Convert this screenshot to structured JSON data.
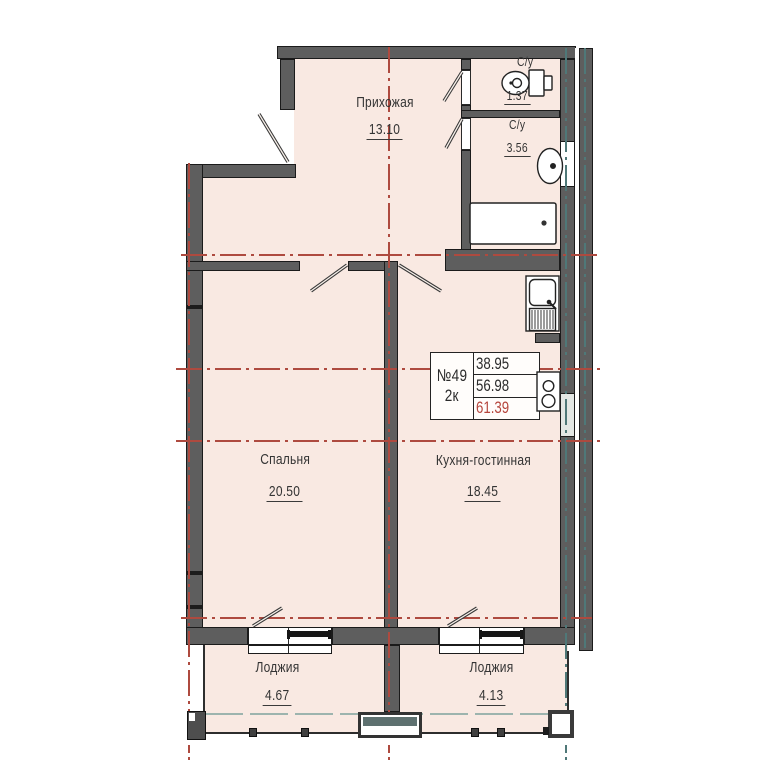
{
  "plan_type": "apartment floor plan",
  "stamp": {
    "apartment_number": "№49",
    "rooms_label": "2к",
    "living_area": "38.95",
    "area_without_loggias": "56.98",
    "total_area": "61.39"
  },
  "rooms": {
    "hallway": {
      "name": "Прихожая",
      "area": "13.10"
    },
    "wc_small": {
      "name": "С/у",
      "area": "1.37"
    },
    "wc_big": {
      "name": "С/у",
      "area": "3.56"
    },
    "bedroom": {
      "name": "Спальня",
      "area": "20.50"
    },
    "kitchen": {
      "name": "Кухня-гостинная",
      "area": "18.45"
    },
    "loggia_left": {
      "name": "Лоджия",
      "area": "4.67"
    },
    "loggia_right": {
      "name": "Лоджия",
      "area": "4.13"
    }
  },
  "icons": {
    "toilet": "toilet-top-view",
    "washbasin": "washbasin-top-view",
    "bathtub": "bathtub-top-view",
    "kitchen_sink": "kitchen-sink-with-drainer-top-view",
    "stove": "two-burner-cooktop-top-view"
  },
  "colors": {
    "wall_gray": "#5e5e5e",
    "room_fill": "#f9e9e2",
    "axis_red": "#ae4a3f",
    "axis_teal": "#4f7878",
    "total_area_red": "#b5453c"
  }
}
